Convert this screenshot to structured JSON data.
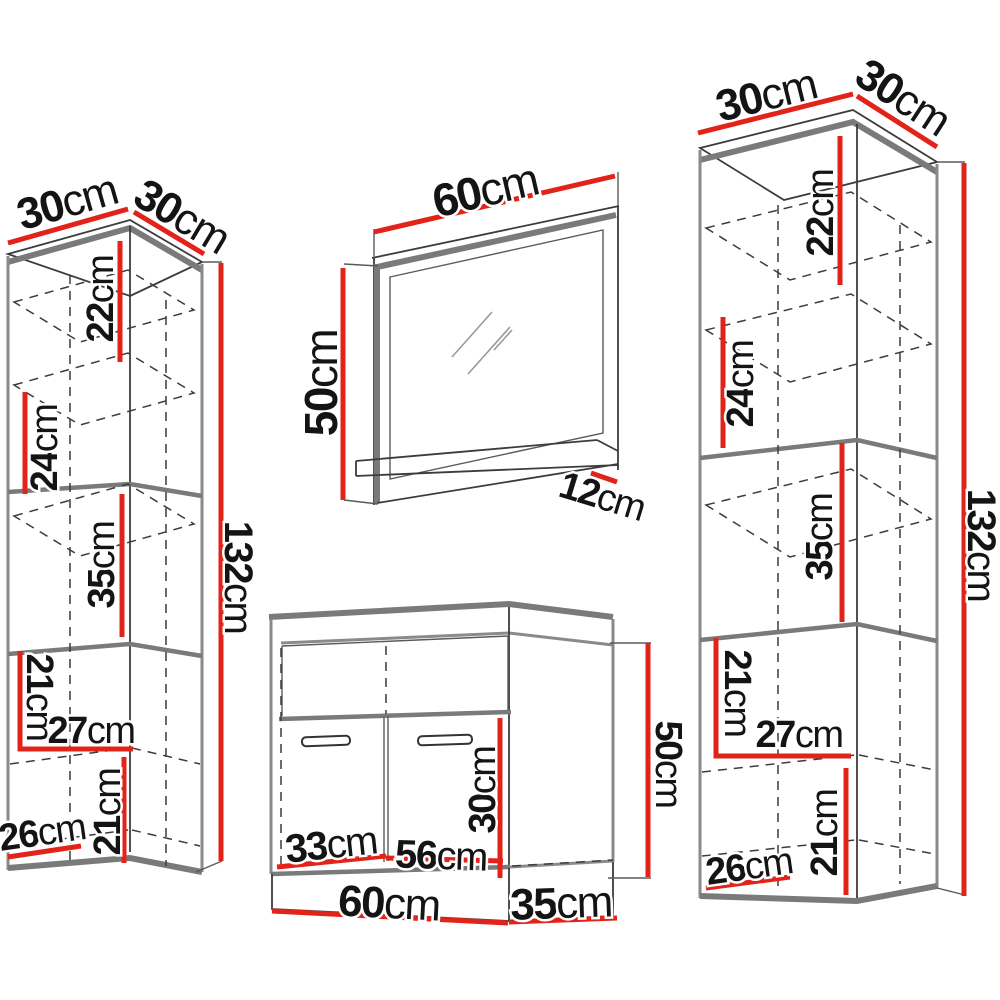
{
  "page": {
    "background": "#ffffff"
  },
  "colors": {
    "dimension_line_red": "#e2231a",
    "cabinet_outline_gray": "#7a7a7a",
    "drawing_line_dark": "#3c3c3c",
    "label_text": "#141414"
  },
  "diagram": {
    "unit": "cm",
    "left_cabinet": {
      "name": "left tall wall cabinet",
      "width_top": {
        "value": "30",
        "unit": "cm"
      },
      "depth_top": {
        "value": "30",
        "unit": "cm"
      },
      "sec22": {
        "value": "22",
        "unit": "cm"
      },
      "sec24": {
        "value": "24",
        "unit": "cm"
      },
      "sec35": {
        "value": "35",
        "unit": "cm"
      },
      "sec21a": {
        "value": "21",
        "unit": "cm"
      },
      "w27": {
        "value": "27",
        "unit": "cm"
      },
      "sec21b": {
        "value": "21",
        "unit": "cm"
      },
      "d26": {
        "value": "26",
        "unit": "cm"
      },
      "h132": {
        "value": "132",
        "unit": "cm"
      }
    },
    "mirror": {
      "name": "wall mirror with shelf",
      "w60": {
        "value": "60",
        "unit": "cm"
      },
      "h50": {
        "value": "50",
        "unit": "cm"
      },
      "d12": {
        "value": "12",
        "unit": "cm"
      }
    },
    "vanity": {
      "name": "sink base cabinet",
      "i33": {
        "value": "33",
        "unit": "cm"
      },
      "i56": {
        "value": "56",
        "unit": "cm"
      },
      "i30": {
        "value": "30",
        "unit": "cm"
      },
      "w60": {
        "value": "60",
        "unit": "cm"
      },
      "d35": {
        "value": "35",
        "unit": "cm"
      },
      "h50": {
        "value": "50",
        "unit": "cm"
      }
    },
    "right_cabinet": {
      "name": "right tall wall cabinet",
      "width_top": {
        "value": "30",
        "unit": "cm"
      },
      "depth_top": {
        "value": "30",
        "unit": "cm"
      },
      "sec22": {
        "value": "22",
        "unit": "cm"
      },
      "sec24": {
        "value": "24",
        "unit": "cm"
      },
      "sec35": {
        "value": "35",
        "unit": "cm"
      },
      "sec21a": {
        "value": "21",
        "unit": "cm"
      },
      "w27": {
        "value": "27",
        "unit": "cm"
      },
      "sec21b": {
        "value": "21",
        "unit": "cm"
      },
      "d26": {
        "value": "26",
        "unit": "cm"
      },
      "h132": {
        "value": "132",
        "unit": "cm"
      }
    }
  }
}
